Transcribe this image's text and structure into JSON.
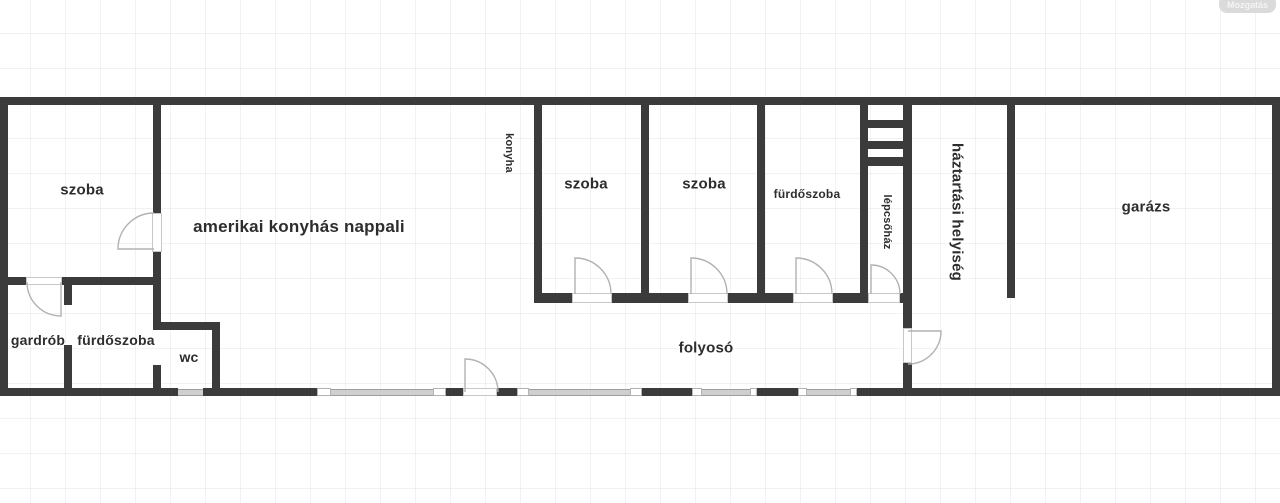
{
  "watermark": {
    "label": "Mozgatás"
  },
  "rooms": {
    "szoba_left": "szoba",
    "nappali": "amerikai konyhás nappali",
    "konyha": "konyha",
    "szoba_1": "szoba",
    "szoba_2": "szoba",
    "furdoszoba_mid": "fürdőszoba",
    "lepcsohaz": "lépcsőház",
    "haztartasi": "háztartási helyiség",
    "garazs": "garázs",
    "gardrob": "gardrób",
    "furdoszoba_left": "fürdőszoba",
    "wc": "wc",
    "folyoso": "folyosó"
  },
  "colors": {
    "wall": "#3b3b3b",
    "window": "#cfcfcf",
    "door_arc": "#b2b2b2",
    "label": "#2d2d2d",
    "grid": "#e9ebef"
  }
}
